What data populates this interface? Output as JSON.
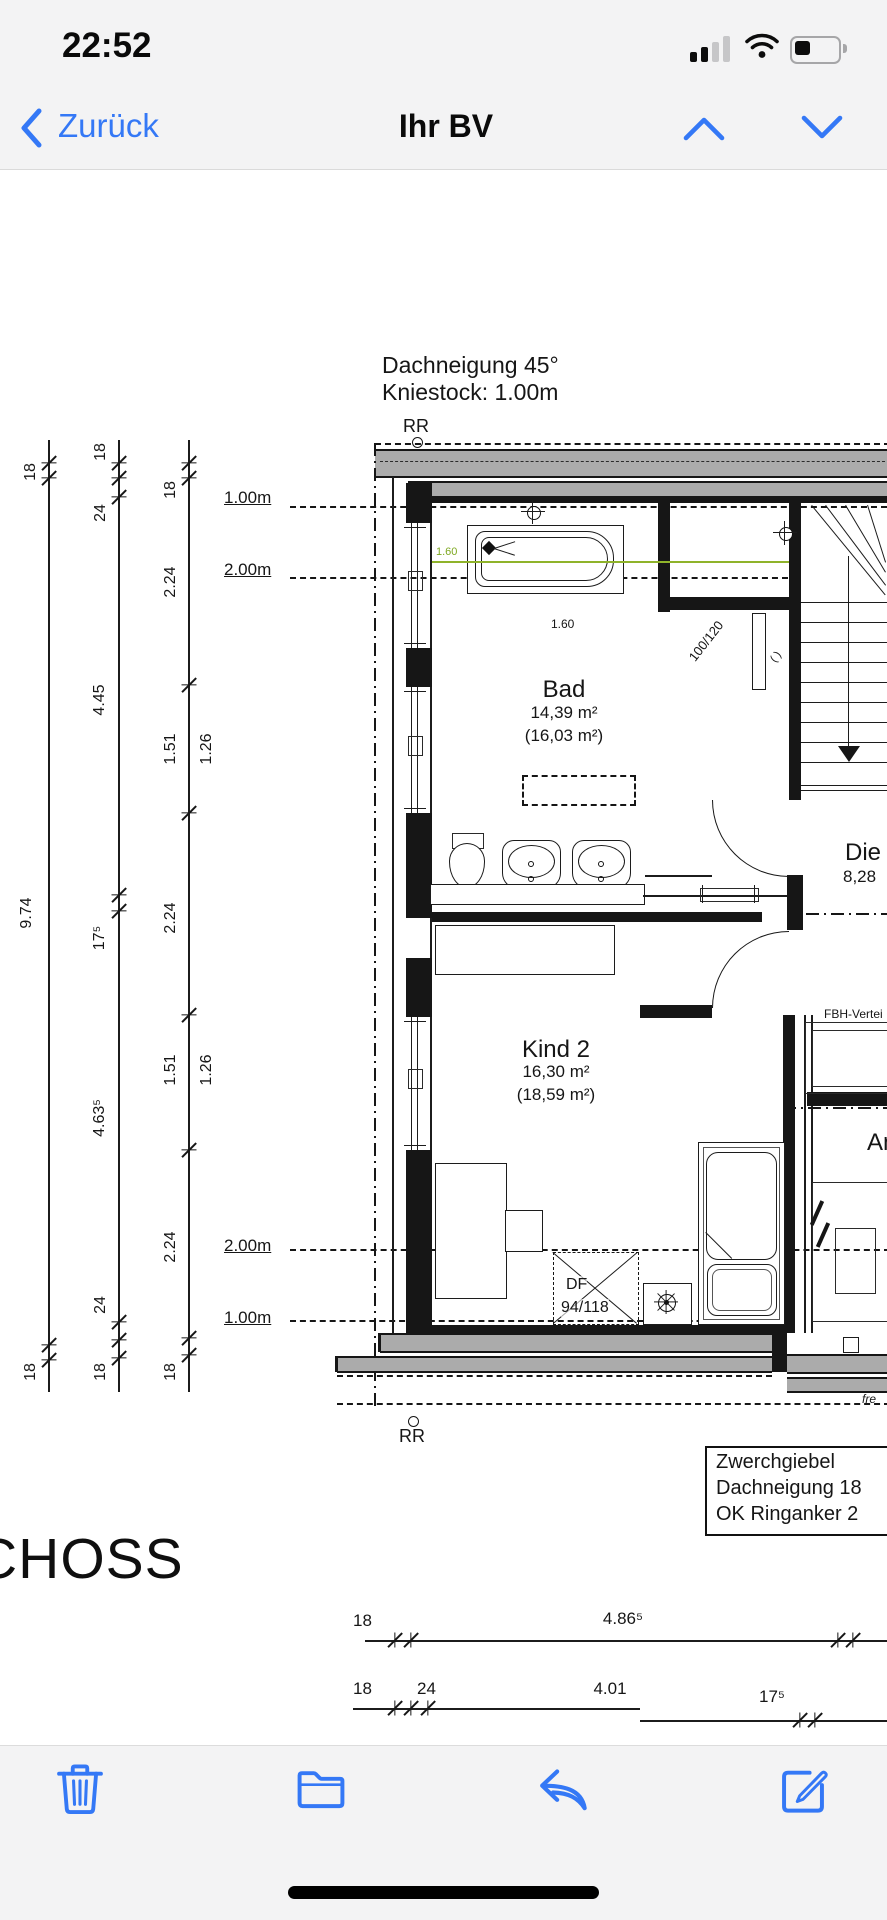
{
  "status_bar": {
    "time": "22:52"
  },
  "nav_bar": {
    "back_label": "Zurück",
    "title": "Ihr BV"
  },
  "toolbar": {
    "icons": [
      "trash",
      "folder",
      "reply",
      "compose"
    ]
  },
  "colors": {
    "accent": "#3478F6",
    "wall_gray": "#ababab",
    "dim_green": "#8fb32a"
  },
  "plan": {
    "roof_note_line1": "Dachneigung 45°",
    "roof_note_line2": "Kniestock: 1.00m",
    "rr_top": "RR",
    "rr_bottom": "RR",
    "levels": {
      "top_100": "1.00m",
      "top_200": "2.00m",
      "bottom_200": "2.00m",
      "bottom_100": "1.00m"
    },
    "rooms": {
      "bad": {
        "name": "Bad",
        "area": "14,39 m²",
        "area_roof": "(16,03 m²)"
      },
      "kind2": {
        "name": "Kind 2",
        "area": "16,30 m²",
        "area_roof": "(18,59 m²)"
      },
      "diele": {
        "name": "Die",
        "area": "8,28"
      },
      "ankleide": {
        "name": "Ank"
      }
    },
    "labels": {
      "tub_width_green": "1.60",
      "tub_width": "1.60",
      "niche_size": "100/120",
      "niche_bracket": "( )",
      "fbh": "FBH-Vertei",
      "df_line1": "DF",
      "df_line2": "94/118",
      "small_note": "fre"
    },
    "note_box": {
      "line1": "Zwerchgiebel",
      "line2": "Dachneigung 18",
      "line3": "OK Ringanker 2"
    },
    "floor_label": "CHOSS",
    "dims": {
      "chain_a": [
        "18",
        "9.74",
        "18"
      ],
      "chain_b": [
        "18",
        "24",
        "4.45",
        "17⁵",
        "4.63⁵",
        "24",
        "18"
      ],
      "chain_c": [
        "18",
        "2.24",
        "1.51",
        "2.24",
        "1.51",
        "2.24",
        "18"
      ],
      "chain_c_inner": [
        "1.26",
        "1.26"
      ],
      "bottom_row1": [
        "18",
        "4.86⁵"
      ],
      "bottom_row2": [
        "18",
        "24",
        "4.01",
        "17⁵"
      ]
    }
  }
}
